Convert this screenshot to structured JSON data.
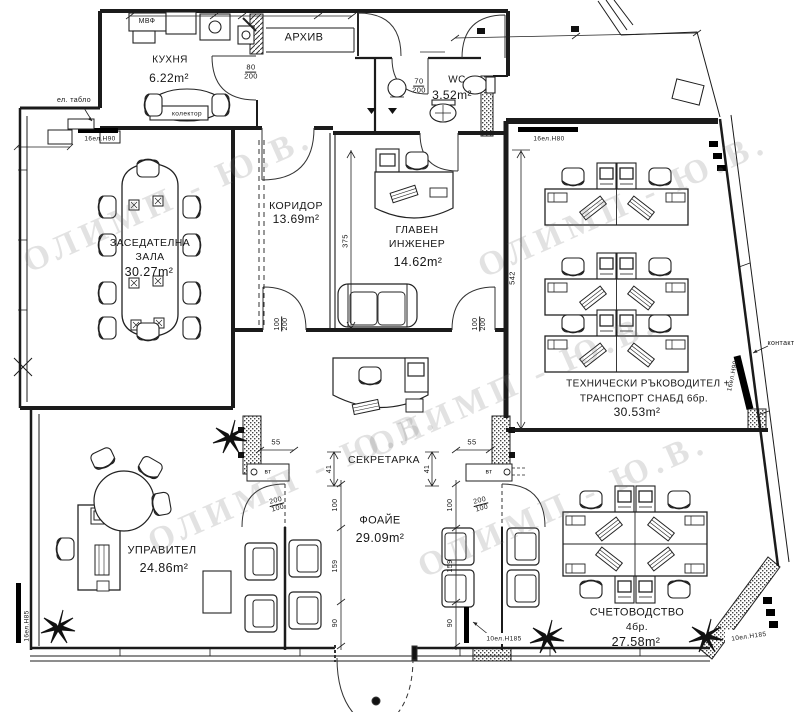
{
  "watermark": {
    "text": "ОЛИМП - Ю.В.",
    "color": "#7a7a7a"
  },
  "rooms": {
    "kitchen": {
      "name": "КУХНЯ",
      "area": "6.22m²"
    },
    "archive": {
      "name": "АРХИВ"
    },
    "wc": {
      "name": "WC",
      "area": "3.52m²"
    },
    "meeting": {
      "name_line1": "ЗАСЕДАТЕЛНА",
      "name_line2": "ЗАЛА",
      "area": "30.27m²"
    },
    "corridor": {
      "name": "КОРИДОР",
      "area": "13.69m²"
    },
    "chief": {
      "name_line1": "ГЛАВЕН",
      "name_line2": "ИНЖЕНЕР",
      "area": "14.62m²"
    },
    "tech": {
      "name_line1": "ТЕХНИЧЕСКИ РЪКОВОДИТЕЛ +",
      "name_line2": "ТРАНСПОРТ СНАБД 6бр.",
      "area": "30.53m²"
    },
    "secretary": {
      "name": "СЕКРЕТАРКА"
    },
    "foyer": {
      "name": "ФОАЙЕ",
      "area": "29.09m²"
    },
    "manager": {
      "name": "УПРАВИТЕЛ",
      "area": "24.86m²"
    },
    "accounting": {
      "name": "СЧЕТОВОДСТВО",
      "count": "4бр.",
      "area": "27.58m²"
    }
  },
  "door_sizes": {
    "kitchen": {
      "num": "80",
      "den": "200"
    },
    "wc": {
      "num": "70",
      "den": "200"
    },
    "corridor_left": {
      "num": "100",
      "den": "200"
    },
    "chief_right": {
      "num": "100",
      "den": "200"
    },
    "manager": {
      "num": "200",
      "den": "100"
    },
    "accounting": {
      "num": "200",
      "den": "100"
    }
  },
  "dims": {
    "chief_depth": "375",
    "tech_depth": "542",
    "sec_left": "41",
    "sec_right": "41",
    "col_left": "55",
    "col_right": "55",
    "foyer_left": [
      "100",
      "159",
      "90"
    ],
    "foyer_right": [
      "100",
      "159",
      "90"
    ]
  },
  "electrical": {
    "panel": "ел. табло",
    "collector": "колектор",
    "mvf": "МВФ",
    "contact": "контакт",
    "vt_left": "вт",
    "vt_right": "вт",
    "strip_top_left": "16ел.H90",
    "strip_top_right": "16ел.H80",
    "strip_right_diag": "16ел.H90",
    "strip_left_wall": "16ел.H85",
    "strip_foyer": "10ел.H185",
    "strip_corner": "10ел.H185"
  }
}
